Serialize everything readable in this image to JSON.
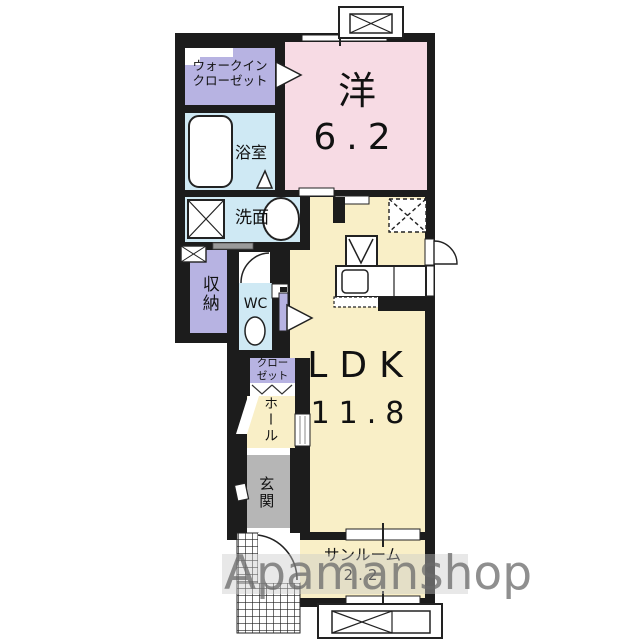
{
  "watermark": {
    "text": "Apamanshop"
  },
  "floorplan": {
    "rooms": {
      "western_room": {
        "name": "洋",
        "size": "6.2"
      },
      "walk_in_closet": {
        "line1": "ウォークイン",
        "line2": "クローゼット"
      },
      "bathroom": {
        "name": "浴室"
      },
      "washroom": {
        "name": "洗面"
      },
      "storage": {
        "name": "収納"
      },
      "toilet": {
        "name": "WC"
      },
      "closet": {
        "line1": "クロー",
        "line2": "ゼット"
      },
      "hall": {
        "name": "ホール"
      },
      "ldk": {
        "name": "LDK",
        "size": "11.8"
      },
      "entrance": {
        "name": "玄関"
      },
      "sunroom": {
        "name": "サンルーム",
        "size": "2.2"
      }
    },
    "colors": {
      "wall": "#1c1c1c",
      "western_room": "#f7dbe4",
      "ldk": "#f9efc7",
      "closet_purple": "#b7b3e2",
      "wet_blue": "#cfe9f4",
      "entrance_gray": "#b6b6b6"
    }
  }
}
